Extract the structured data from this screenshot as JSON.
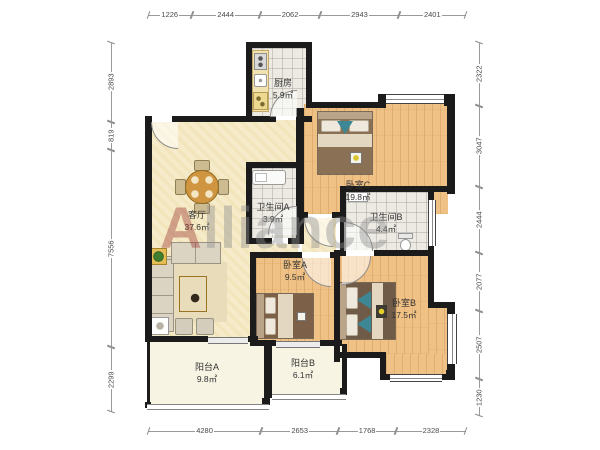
{
  "watermark": {
    "first_letter": "A",
    "rest": "lliance"
  },
  "rooms": [
    {
      "id": "kitchen",
      "name": "厨房",
      "area": "5.9㎡"
    },
    {
      "id": "bedroom-c",
      "name": "卧室C",
      "area": "19.8㎡"
    },
    {
      "id": "bathroom-a",
      "name": "卫生间A",
      "area": "3.9㎡"
    },
    {
      "id": "bathroom-b",
      "name": "卫生间B",
      "area": "4.4㎡"
    },
    {
      "id": "living-room",
      "name": "客厅",
      "area": "37.6㎡"
    },
    {
      "id": "bedroom-a",
      "name": "卧室A",
      "area": "9.5㎡"
    },
    {
      "id": "bedroom-b",
      "name": "卧室B",
      "area": "17.5㎡"
    },
    {
      "id": "balcony-a",
      "name": "阳台A",
      "area": "9.8㎡"
    },
    {
      "id": "balcony-b",
      "name": "阳台B",
      "area": "6.1㎡"
    }
  ],
  "dimensions": {
    "top": [
      "1226",
      "2444",
      "2062",
      "2943",
      "2401"
    ],
    "bottom": [
      "4280",
      "2653",
      "1768",
      "2328"
    ],
    "left": [
      "2893",
      "819",
      "7556",
      "2299"
    ],
    "right": [
      "2322",
      "3047",
      "2444",
      "2077",
      "2507",
      "1230"
    ]
  },
  "colors": {
    "wall": "#1b1b1b",
    "wood": "#f0c185",
    "tile": "#eceae3",
    "living": "#f6ebc8",
    "balcony": "#f7f4e3",
    "wm-accent": "#9c3b35",
    "wm-gray": "#8f8f8f"
  }
}
